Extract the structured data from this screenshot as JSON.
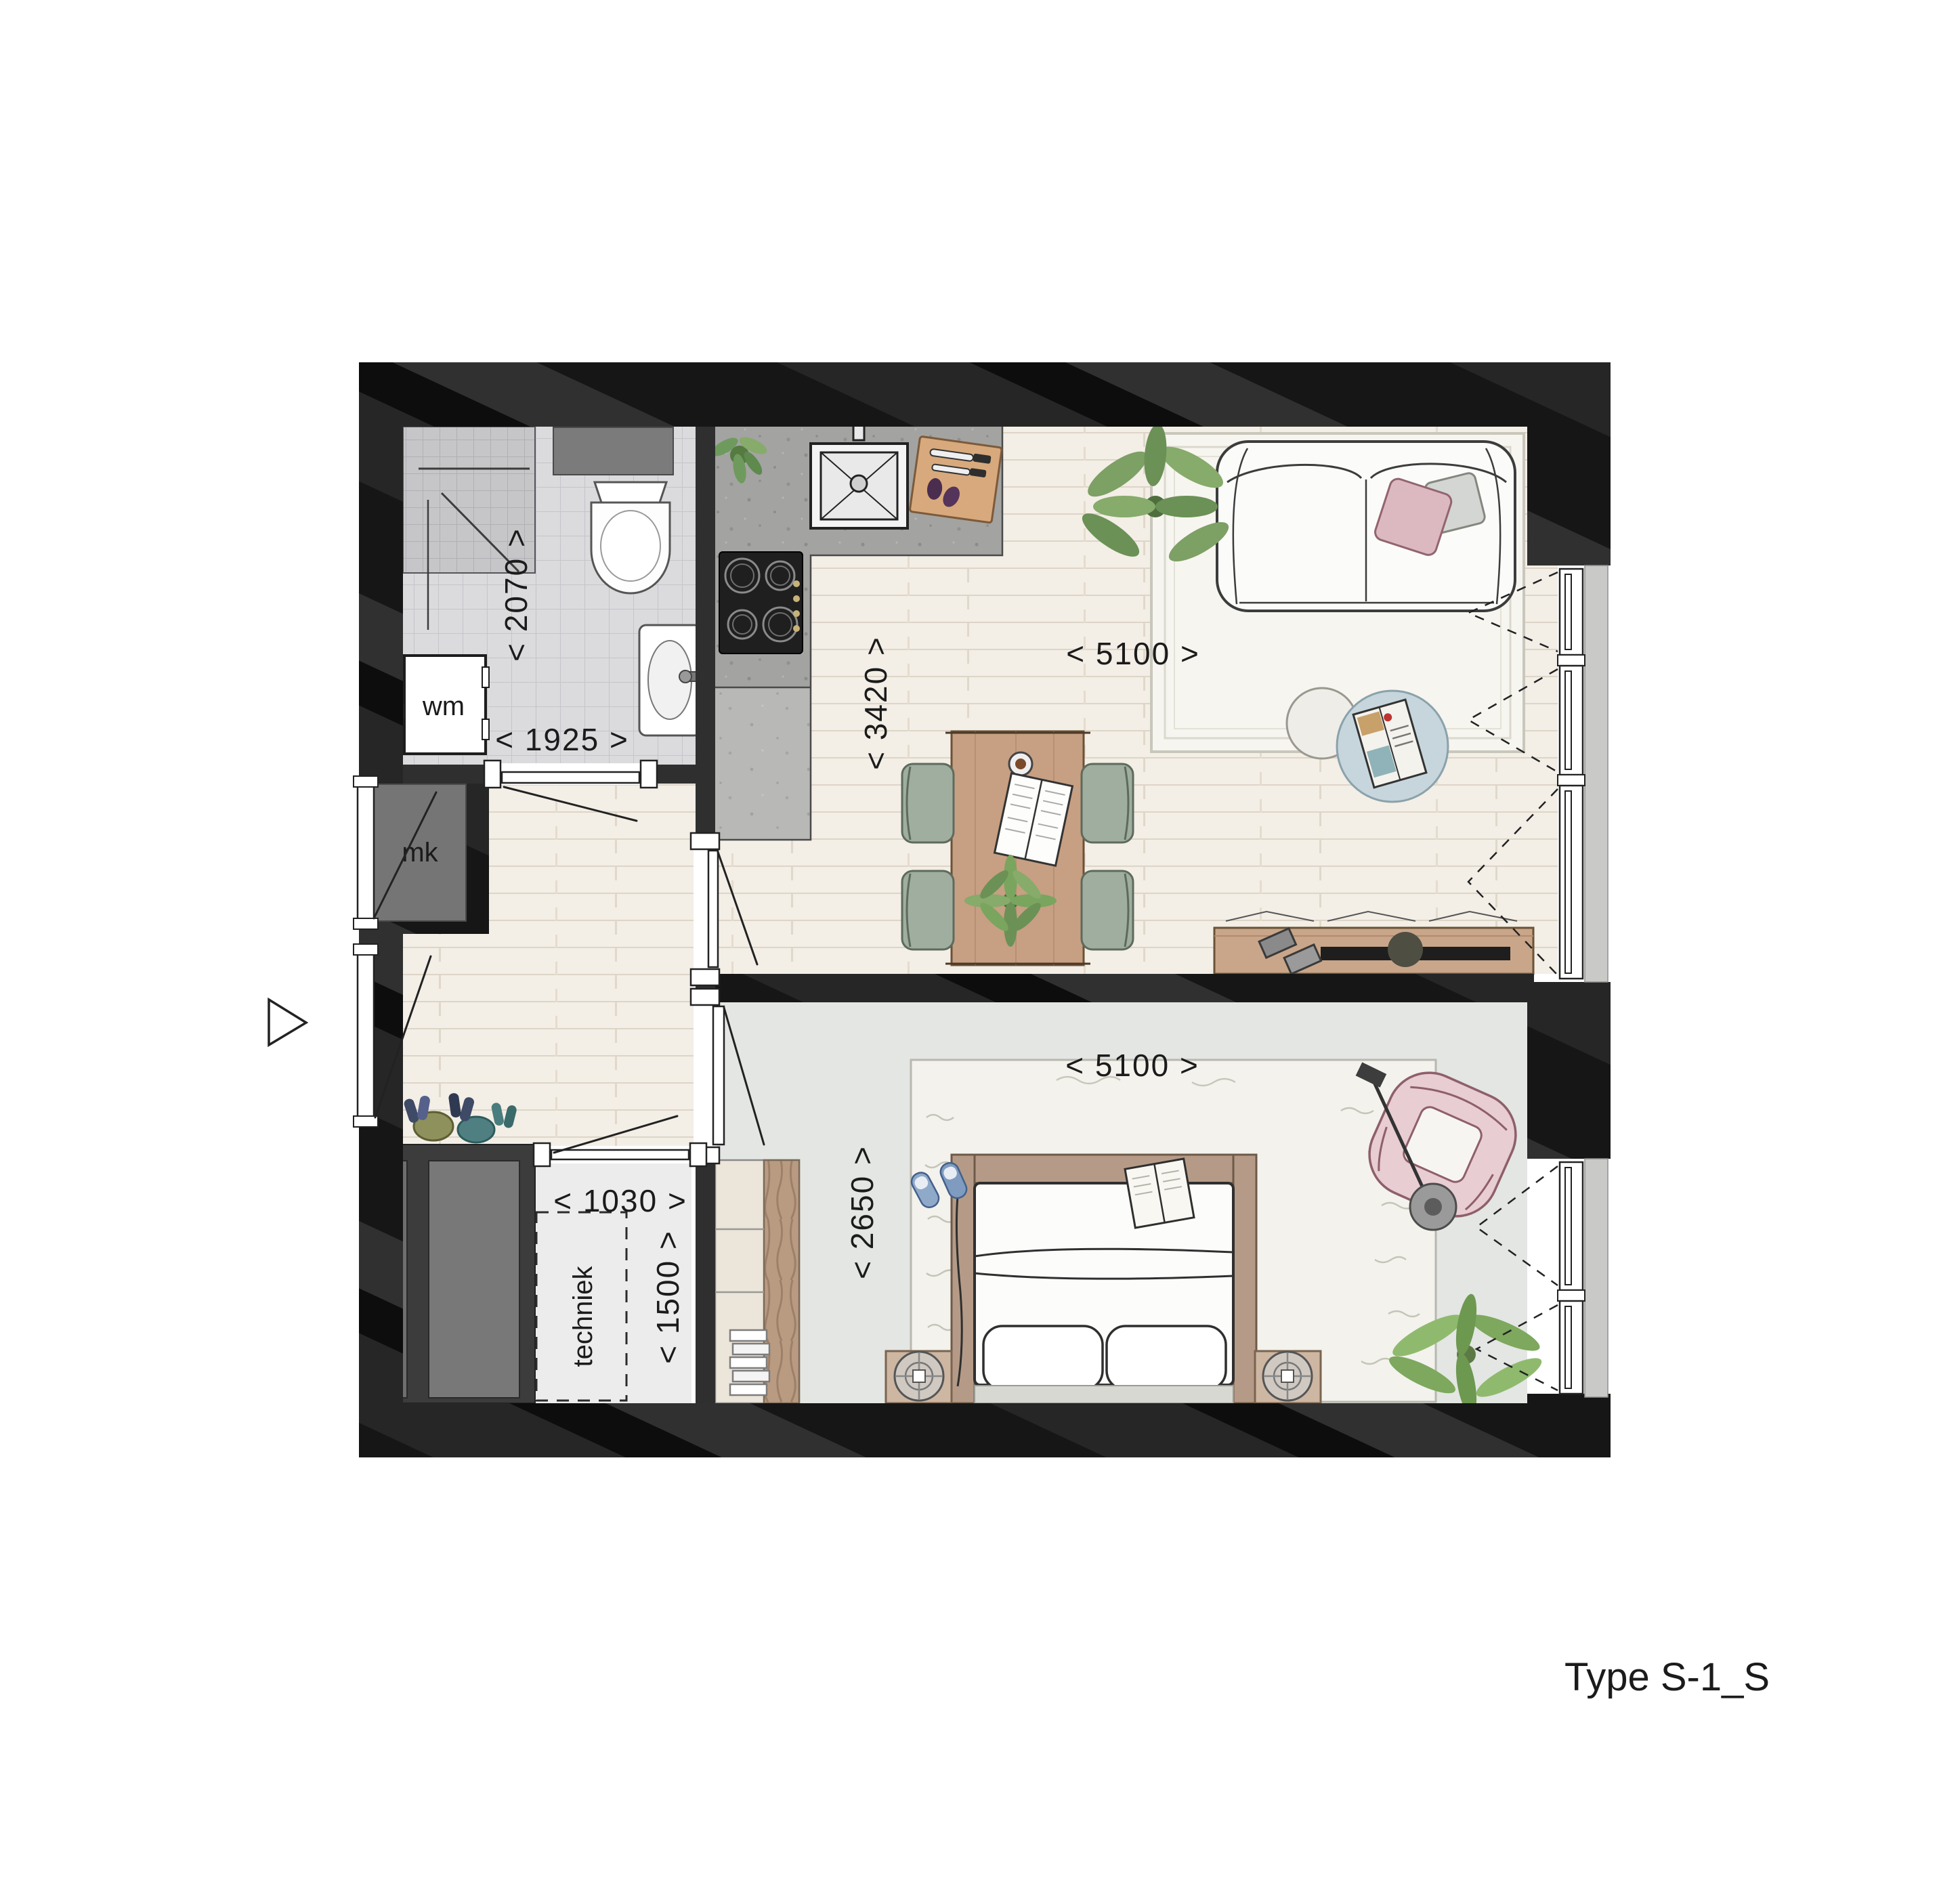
{
  "plan": {
    "title": "Type S-1_S",
    "labels": {
      "shower_depth": "< 2070 >",
      "bath_width": "< 1925 >",
      "washing_machine": "wm",
      "meter_cupboard": "mk",
      "kitchen_depth": "< 3420 >",
      "living_width": "< 5100 >",
      "bedroom_width": "< 5100 >",
      "bedroom_depth": "< 2650 >",
      "tech_width": "< 1030 >",
      "tech_depth": "< 1500 >",
      "tech_room": "techniek"
    },
    "colors": {
      "wall_dark": "#181818",
      "wall_mid": "#2f2f2f",
      "mk_gray": "#757575",
      "tile": "#dbdbde",
      "tile_shower": "#c6c6c9",
      "wood_floor": "#f3eee6",
      "bedroom_floor": "#e3e6e2",
      "tech_floor": "#ececec",
      "concrete": "#a3a3a1",
      "concrete_light": "#b8b8b6",
      "wood_furniture": "#c79f82",
      "chair_sage": "#9fae9f",
      "pillow_pink": "#dcb9c1",
      "armchair_pink": "#e8cdd3",
      "coffee_table_blue": "#c7d6dc",
      "window_sill": "#c9c9c7",
      "plant_green": "#7da065"
    }
  }
}
